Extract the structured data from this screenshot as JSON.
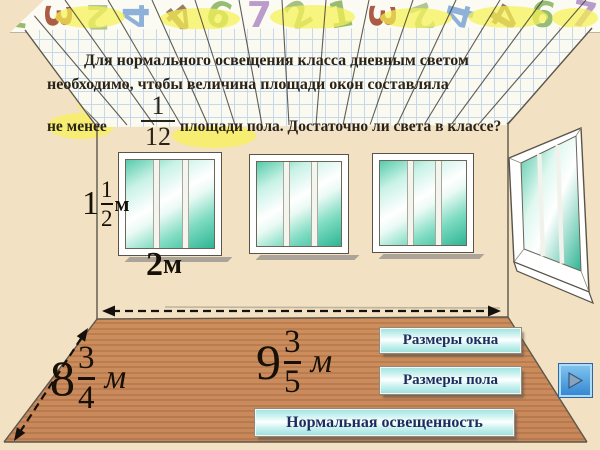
{
  "slide": {
    "problem_text": {
      "line1": "Для нормального освещения класса дневным светом",
      "line2": "необходимо, чтобы величина площади окон составляла",
      "line3_prefix": "не менее",
      "fraction": {
        "numerator": "1",
        "denominator": "12"
      },
      "line3_suffix": "площади пола. Достаточно ли света в классе?"
    },
    "labels": {
      "window_height": {
        "whole": "1",
        "num": "1",
        "den": "2",
        "unit": "м"
      },
      "window_width": {
        "value": "2",
        "unit": "м"
      },
      "floor_width": {
        "whole": "8",
        "num": "3",
        "den": "4",
        "unit": "м"
      },
      "floor_length": {
        "whole": "9",
        "num": "3",
        "den": "5",
        "unit": "м"
      }
    },
    "buttons": [
      {
        "label": "Размеры окна"
      },
      {
        "label": "Размеры пола"
      },
      {
        "label": "Нормальная освещенность"
      }
    ],
    "nav": {
      "icon": "play-arrow-right"
    },
    "border_digits": [
      {
        "ch": "1",
        "color": "#8fb564",
        "rot": 8
      },
      {
        "ch": "3",
        "color": "#a34b33",
        "rot": 90
      },
      {
        "ch": "2",
        "color": "#a9c186",
        "rot": 180
      },
      {
        "ch": "4",
        "color": "#82aad6",
        "rot": -90
      },
      {
        "ch": "4",
        "color": "#8d6e54",
        "rot": 140
      },
      {
        "ch": "6",
        "color": "#8db768",
        "rot": 20
      },
      {
        "ch": "7",
        "color": "#b292c6",
        "rot": 0
      },
      {
        "ch": "2",
        "color": "#9cba74",
        "rot": -30
      },
      {
        "ch": "1",
        "color": "#8fb564",
        "rot": -10
      },
      {
        "ch": "3",
        "color": "#a34b33",
        "rot": 90
      },
      {
        "ch": "2",
        "color": "#a9c186",
        "rot": 160
      },
      {
        "ch": "4",
        "color": "#82aad6",
        "rot": -75
      },
      {
        "ch": "4",
        "color": "#8d6e54",
        "rot": 120
      },
      {
        "ch": "6",
        "color": "#8db768",
        "rot": 10
      },
      {
        "ch": "7",
        "color": "#b292c6",
        "rot": 12
      }
    ]
  },
  "colors": {
    "background_beige": "#f2e2c3",
    "button_cyan": "#aeeae6",
    "button_text_navy": "#1b2c5e",
    "glass_teal": "#2eb594",
    "floor_wood": "#c98a58",
    "lamp_yellow": "#f7f153",
    "nav_blue": "#3184d2",
    "ink": "#29231a"
  }
}
